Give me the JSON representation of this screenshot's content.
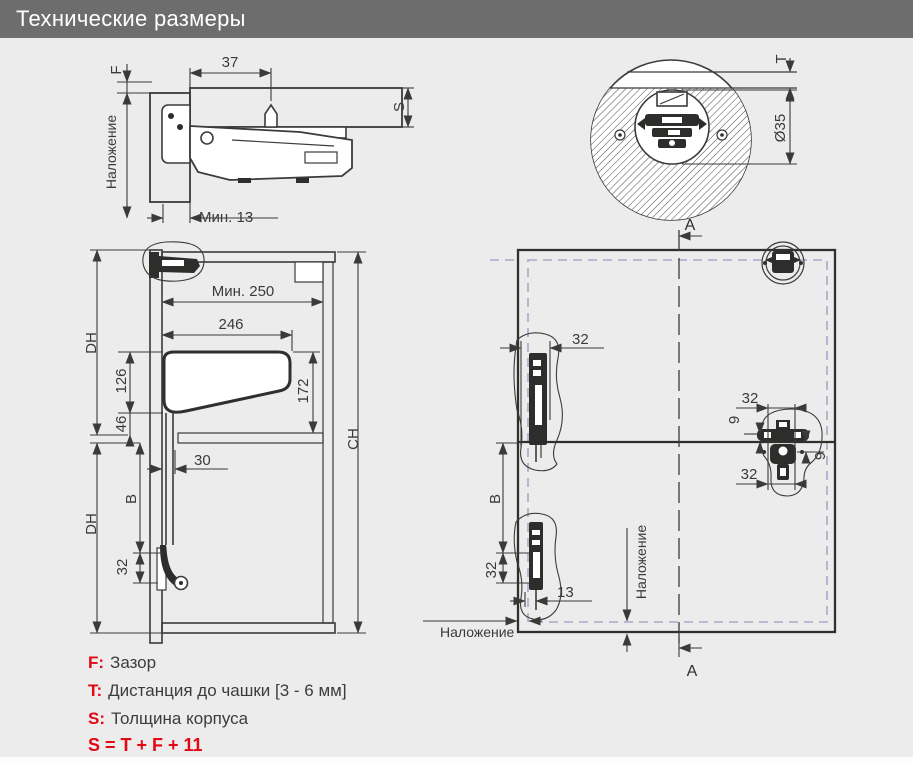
{
  "header": {
    "title": "Технические размеры"
  },
  "colors": {
    "header_bg": "#6d6d6d",
    "page_bg": "#ececec",
    "line": "#3b3b3a",
    "accent_red": "#e30613",
    "dashed_front": "#a9a9c9"
  },
  "side_view": {
    "f": "F",
    "w37": "37",
    "s": "S",
    "overlay": "Наложение",
    "min13": "Мин. 13"
  },
  "cup_view": {
    "t": "T",
    "dia35": "Ø35"
  },
  "cabinet_view": {
    "dh_top": "DH",
    "dh_bottom": "DH",
    "min250": "Мин. 250",
    "d246": "246",
    "d126": "126",
    "d46": "46",
    "d172": "172",
    "d30": "30",
    "b": "B",
    "d32": "32",
    "ch": "CH"
  },
  "front_view": {
    "a_top": "A",
    "a_bottom": "A",
    "d32_left_top": "32",
    "d32_mid_top": "32",
    "d9_left": "9",
    "d9_right": "9",
    "d32_mid_bottom": "32",
    "b": "B",
    "d32_left_bottom": "32",
    "d13": "13",
    "overlay_mid": "Наложение",
    "overlay_bottom": "Наложение"
  },
  "legend": {
    "rows": [
      {
        "key": "F:",
        "text": "Зазор"
      },
      {
        "key": "T:",
        "text": "Дистанция до чашки [3 - 6 мм]"
      },
      {
        "key": "S:",
        "text": "Толщина корпуса"
      }
    ],
    "formula": "S = T + F + 11"
  }
}
